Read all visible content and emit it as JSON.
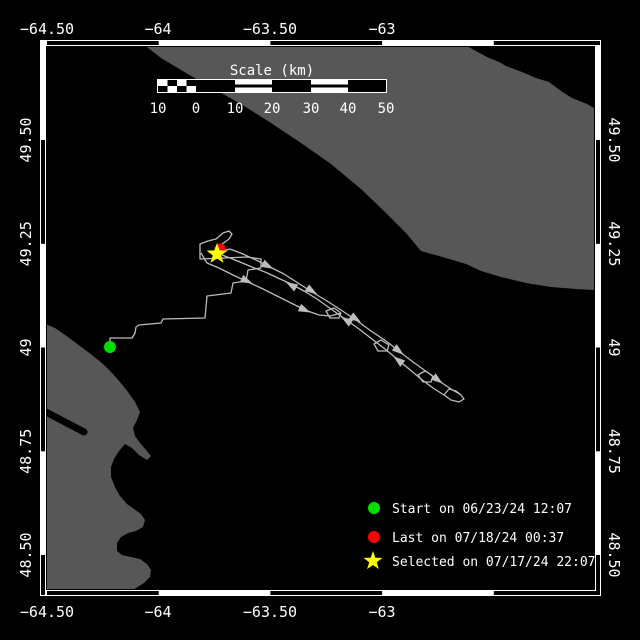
{
  "window": {
    "width": 640,
    "height": 640
  },
  "colors": {
    "water": "#000000",
    "land": "#575757",
    "frame": "#ffffff",
    "track": "#bdbdbd",
    "text": "#ffffff",
    "start": "#00e000",
    "last": "#ff0000",
    "selected": "#ffff00"
  },
  "axes": {
    "top": [
      "−64.50",
      "−64",
      "−63.50",
      "−63"
    ],
    "bottom": [
      "−64.50",
      "−64",
      "−63.50",
      "−63"
    ],
    "left": [
      "49.50",
      "49.25",
      "49",
      "48.75",
      "48.50"
    ],
    "right": [
      "49.50",
      "49.25",
      "49",
      "48.75",
      "48.50"
    ]
  },
  "frame": {
    "x0": 40,
    "y0": 40,
    "x1": 601,
    "y1": 596,
    "band": 6,
    "x_ticks": [
      47,
      158.7,
      270.4,
      382.1,
      493.8
    ],
    "y_ticks": [
      140,
      243.8,
      347.5,
      451.3,
      555
    ]
  },
  "scale_bar": {
    "title": "Scale (km)",
    "labels": [
      "10",
      "0",
      "10",
      "20",
      "30",
      "40",
      "50"
    ],
    "ticks_px": [
      158,
      196,
      235,
      272,
      311,
      348,
      386
    ],
    "bar": {
      "x0": 158,
      "x1": 386,
      "y": 80,
      "h": 12,
      "checker_end": 196,
      "striped": [
        [
          235,
          272
        ],
        [
          311,
          348
        ]
      ]
    }
  },
  "legend": {
    "marker_x": 374,
    "text_x": 392,
    "items": [
      {
        "marker": "circle",
        "color": "#00e000",
        "label": "Start on 06/23/24 12:07",
        "cy": 508,
        "ty": 513
      },
      {
        "marker": "circle",
        "color": "#ff0000",
        "label": "Last on 07/18/24 00:37",
        "cy": 537,
        "ty": 542
      },
      {
        "marker": "star",
        "color": "#ffff00",
        "label": "Selected on 07/17/24 22:07",
        "cy": 561,
        "ty": 566
      }
    ]
  },
  "map_data": {
    "land_ne": [
      [
        143,
        40
      ],
      [
        465,
        40
      ],
      [
        467,
        46
      ],
      [
        474,
        50
      ],
      [
        487,
        57
      ],
      [
        499,
        62
      ],
      [
        506,
        66
      ],
      [
        522,
        72
      ],
      [
        536,
        78
      ],
      [
        549,
        82
      ],
      [
        561,
        91
      ],
      [
        572,
        98
      ],
      [
        587,
        104
      ],
      [
        594,
        108
      ],
      [
        594,
        290
      ],
      [
        576,
        289
      ],
      [
        551,
        287
      ],
      [
        526,
        283
      ],
      [
        501,
        277
      ],
      [
        481,
        271
      ],
      [
        466,
        264
      ],
      [
        446,
        258
      ],
      [
        421,
        251
      ],
      [
        406,
        233
      ],
      [
        386,
        213
      ],
      [
        361,
        189
      ],
      [
        331,
        164
      ],
      [
        301,
        143
      ],
      [
        271,
        123
      ],
      [
        241,
        104
      ],
      [
        214,
        89
      ],
      [
        186,
        73
      ],
      [
        161,
        58
      ],
      [
        143,
        44
      ]
    ],
    "land_sw": [
      [
        41,
        322
      ],
      [
        55,
        328
      ],
      [
        68,
        337
      ],
      [
        80,
        346
      ],
      [
        92,
        355
      ],
      [
        103,
        364
      ],
      [
        112,
        373
      ],
      [
        120,
        382
      ],
      [
        128,
        392
      ],
      [
        135,
        402
      ],
      [
        140,
        412
      ],
      [
        137,
        420
      ],
      [
        133,
        428
      ],
      [
        135,
        436
      ],
      [
        140,
        443
      ],
      [
        146,
        450
      ],
      [
        151,
        456
      ],
      [
        147,
        460
      ],
      [
        139,
        455
      ],
      [
        132,
        448
      ],
      [
        125,
        444
      ],
      [
        119,
        451
      ],
      [
        114,
        459
      ],
      [
        111,
        467
      ],
      [
        111,
        477
      ],
      [
        115,
        487
      ],
      [
        120,
        496
      ],
      [
        127,
        504
      ],
      [
        134,
        509
      ],
      [
        141,
        514
      ],
      [
        145,
        520
      ],
      [
        143,
        527
      ],
      [
        136,
        531
      ],
      [
        128,
        533
      ],
      [
        121,
        537
      ],
      [
        117,
        543
      ],
      [
        117,
        551
      ],
      [
        122,
        555
      ],
      [
        131,
        557
      ],
      [
        140,
        559
      ],
      [
        147,
        564
      ],
      [
        151,
        570
      ],
      [
        150,
        577
      ],
      [
        144,
        583
      ],
      [
        136,
        588
      ],
      [
        128,
        592
      ],
      [
        121,
        596
      ],
      [
        41,
        596
      ]
    ],
    "inlet": {
      "x1": 44,
      "y1": 411,
      "x2": 84,
      "y2": 432,
      "w": 7
    },
    "track": [
      [
        [
          110,
          342
        ],
        [
          110,
          338
        ],
        [
          132,
          338
        ],
        [
          135,
          333
        ],
        [
          136,
          327
        ],
        [
          139,
          325
        ],
        [
          161,
          323
        ],
        [
          163,
          319
        ],
        [
          205,
          318
        ],
        [
          207,
          296
        ],
        [
          231,
          293
        ],
        [
          233,
          283
        ],
        [
          246,
          281
        ],
        [
          248,
          270
        ],
        [
          261,
          268
        ],
        [
          261,
          259
        ],
        [
          247,
          257
        ],
        [
          200,
          259
        ],
        [
          200,
          244
        ],
        [
          208,
          241
        ],
        [
          216,
          239
        ],
        [
          223,
          233
        ],
        [
          229,
          231
        ],
        [
          232,
          234
        ],
        [
          229,
          239
        ],
        [
          221,
          245
        ],
        [
          218,
          250
        ]
      ],
      [
        [
          218,
          252
        ],
        [
          230,
          249
        ],
        [
          243,
          254
        ],
        [
          256,
          260
        ],
        [
          270,
          267
        ],
        [
          284,
          274
        ],
        [
          298,
          283
        ],
        [
          312,
          292
        ],
        [
          327,
          301
        ],
        [
          341,
          310
        ],
        [
          356,
          320
        ],
        [
          371,
          331
        ],
        [
          386,
          341
        ],
        [
          400,
          352
        ],
        [
          413,
          362
        ],
        [
          427,
          372
        ],
        [
          439,
          381
        ],
        [
          451,
          389
        ],
        [
          461,
          395
        ],
        [
          464,
          399
        ],
        [
          459,
          402
        ],
        [
          451,
          400
        ],
        [
          444,
          395
        ],
        [
          449,
          389
        ],
        [
          456,
          391
        ],
        [
          461,
          395
        ]
      ],
      [
        [
          444,
          395
        ],
        [
          433,
          388
        ],
        [
          421,
          379
        ],
        [
          409,
          369
        ],
        [
          397,
          359
        ],
        [
          385,
          349
        ],
        [
          372,
          339
        ],
        [
          359,
          329
        ],
        [
          345,
          319
        ],
        [
          331,
          309
        ],
        [
          317,
          299
        ],
        [
          304,
          291
        ],
        [
          291,
          284
        ],
        [
          278,
          278
        ],
        [
          265,
          272
        ],
        [
          252,
          267
        ],
        [
          240,
          262
        ],
        [
          230,
          258
        ],
        [
          222,
          255
        ]
      ],
      [
        [
          341,
          313
        ],
        [
          334,
          308
        ],
        [
          326,
          311
        ],
        [
          330,
          318
        ],
        [
          339,
          318
        ],
        [
          341,
          313
        ]
      ],
      [
        [
          389,
          345
        ],
        [
          381,
          340
        ],
        [
          374,
          344
        ],
        [
          378,
          351
        ],
        [
          387,
          351
        ],
        [
          389,
          345
        ]
      ],
      [
        [
          433,
          376
        ],
        [
          425,
          371
        ],
        [
          418,
          375
        ],
        [
          423,
          382
        ],
        [
          431,
          382
        ],
        [
          433,
          376
        ]
      ],
      [
        [
          201,
          253
        ],
        [
          207,
          263
        ],
        [
          219,
          268
        ],
        [
          233,
          275
        ],
        [
          248,
          282
        ],
        [
          263,
          289
        ],
        [
          277,
          296
        ],
        [
          291,
          303
        ],
        [
          305,
          310
        ],
        [
          319,
          315
        ],
        [
          330,
          316
        ],
        [
          341,
          313
        ]
      ]
    ],
    "arrows": [
      {
        "x": 268,
        "y": 266,
        "r": 28
      },
      {
        "x": 312,
        "y": 291,
        "r": 32
      },
      {
        "x": 356,
        "y": 319,
        "r": 34
      },
      {
        "x": 399,
        "y": 351,
        "r": 38
      },
      {
        "x": 438,
        "y": 380,
        "r": 37
      },
      {
        "x": 291,
        "y": 285,
        "r": 210
      },
      {
        "x": 346,
        "y": 320,
        "r": 213
      },
      {
        "x": 398,
        "y": 360,
        "r": 218
      },
      {
        "x": 247,
        "y": 281,
        "r": 25
      },
      {
        "x": 305,
        "y": 310,
        "r": 24
      }
    ],
    "markers": {
      "start": {
        "x": 110,
        "y": 347,
        "r": 6
      },
      "last": {
        "x": 220,
        "y": 249,
        "r": 5.5
      },
      "selected": {
        "x": 217,
        "y": 254,
        "R": 11,
        "r": 4.4
      }
    }
  }
}
